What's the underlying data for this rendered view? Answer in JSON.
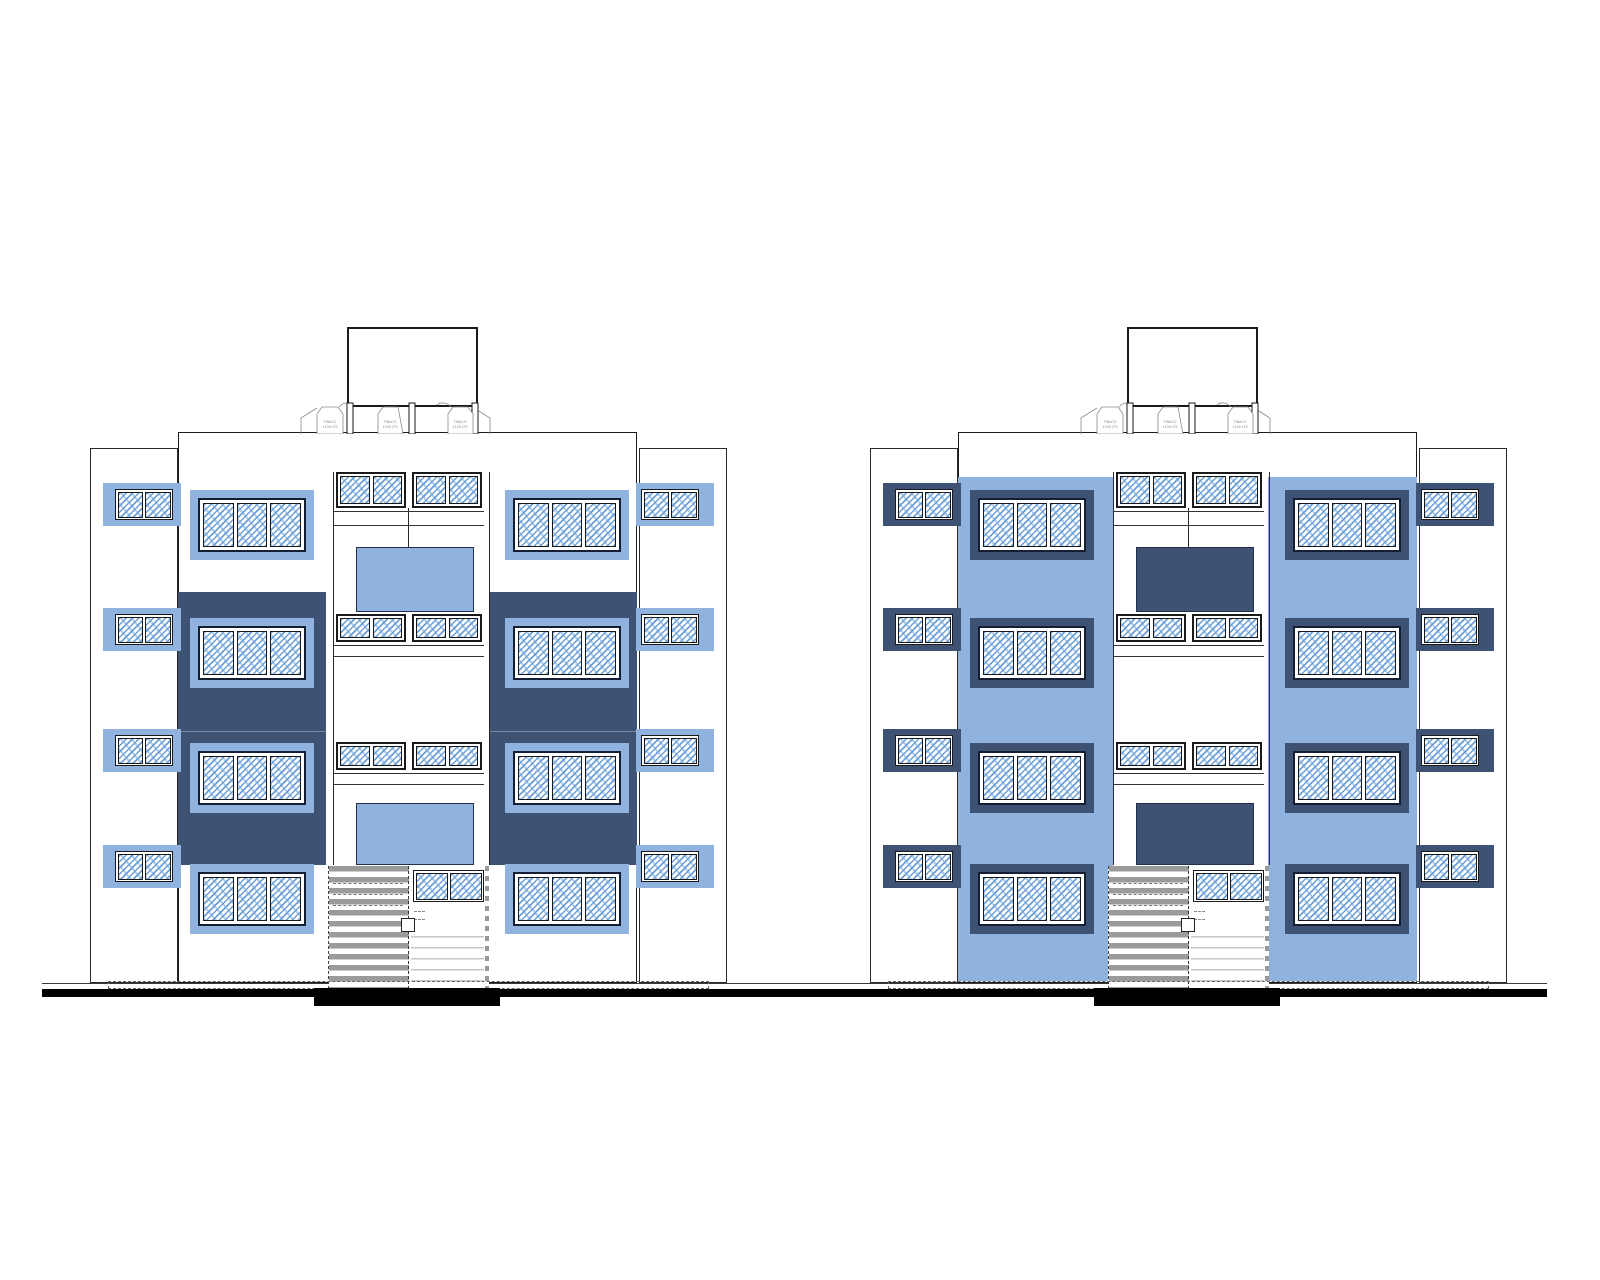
{
  "sheet": {
    "type": "architectural-elevation-drawing",
    "description": "Front elevations of two four-storey apartment blocks",
    "background": "#ffffff"
  },
  "colors": {
    "background": "#ffffff",
    "light_blue": "#8FB3DE",
    "navy": "#3E5373",
    "glass_stroke": "#6B9FD8",
    "glass_stroke_light": "#AECBEA",
    "glass_bg": "#ffffff",
    "line": "#1a1a1a",
    "gray": "#9B9B9B",
    "light_gray": "#C6C6C6",
    "label_gray": "#8A8A8A"
  },
  "rooftop": {
    "tank_label_line1": "TINACO",
    "tank_label_line2": "1100 LTS",
    "tank_count": 3
  },
  "buildings": [
    {
      "id": "left-elevation",
      "accent_scheme": "navy-panels-on-white",
      "floors": 4
    },
    {
      "id": "right-elevation",
      "accent_scheme": "light-blue-facade",
      "floors": 4
    }
  ]
}
